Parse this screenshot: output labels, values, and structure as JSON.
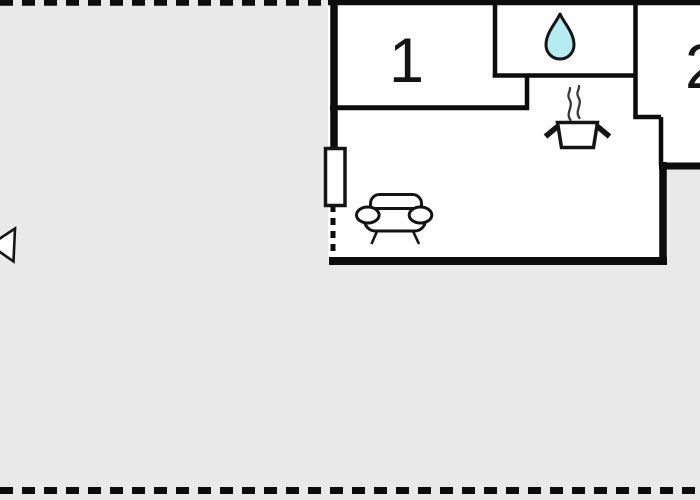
{
  "colors": {
    "background": "#e9e9e9",
    "floor": "#ffffff",
    "wall": "#0c0c0c",
    "outline": "#141414",
    "water_drop_fill": "#b5ecf1",
    "steam": "#3a3a3a"
  },
  "rooms": [
    {
      "label": "1"
    },
    {
      "label": "2"
    }
  ],
  "icons": [
    {
      "name": "water-drop-icon"
    },
    {
      "name": "cooking-pot-icon"
    },
    {
      "name": "steam-icon"
    },
    {
      "name": "sofa-icon"
    },
    {
      "name": "window-symbol"
    },
    {
      "name": "north-arrow-icon"
    }
  ]
}
